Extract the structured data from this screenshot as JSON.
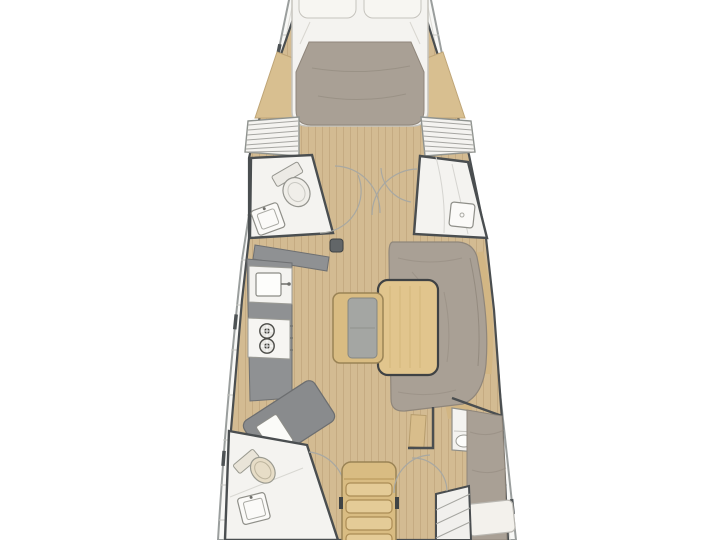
{
  "palette": {
    "background": "#ffffff",
    "deck": "#f8f8f6",
    "deckLine": "#c6c6c1",
    "deckInnerLine": "#dddcd7",
    "hullOutline": "#9a9e9d",
    "hullDash": "#4d5254",
    "wall": "#4a4e50",
    "floorWood": "#d3bb92",
    "floorPlank": "#b09468",
    "furnitureWood": "#d9bc82",
    "furnitureWoodEdge": "#9a8355",
    "tableWood": "#e1c58d",
    "tableEdge": "#3f4244",
    "trimWood": "#d2b684",
    "shelfWood": "#d8bf90",
    "upholstery": "#a9a095",
    "upholsteryShade": "#948b80",
    "upholsteryEdge": "#8f867b",
    "counter": "#8f9193",
    "counterEdge": "#6e7072",
    "navDesk": "#898b8d",
    "fixtureWhite": "#f4f3f0",
    "fixtureLine": "#95958f",
    "linenWhite": "#f3f1ec",
    "linenLine": "#c6c4be",
    "cushionGray": "#a4a6a3",
    "toiletSeat": "#e7ddc7",
    "burnerRing": "#4c4c48",
    "arc": "#a8a8a2",
    "mastGray": "#626668"
  },
  "floorplan": {
    "view": "top-down-deck-plan",
    "vessel": "sailing-yacht-cabin-layout",
    "areas": [
      "forward-cabin-v-berth",
      "port-forward-head",
      "starboard-shower-room",
      "galley",
      "navigation-station",
      "salon-dinette",
      "center-bench",
      "companionway-stairs",
      "port-aft-head",
      "starboard-aft-cabin",
      "side-decks"
    ]
  }
}
